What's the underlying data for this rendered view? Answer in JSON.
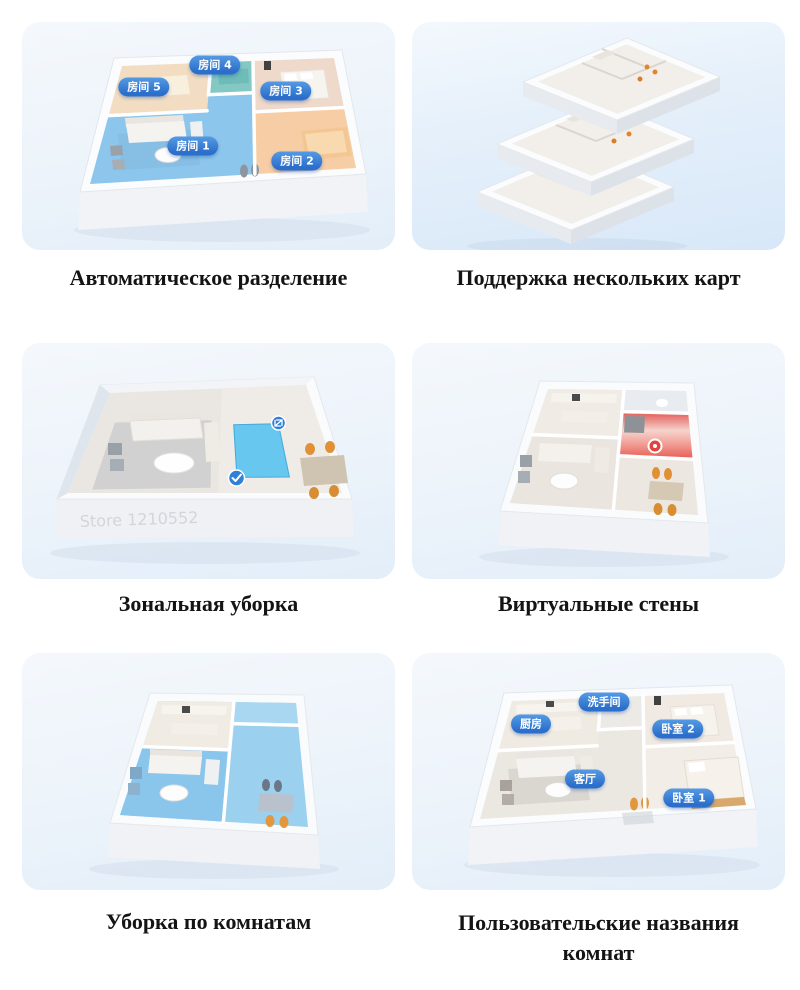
{
  "colors": {
    "badge_blue": "#2e6fce",
    "zone_blue": "#56c5ef",
    "no_go_red": "#e5534e",
    "card_background": "#eaf2fb",
    "caption_text": "#141414"
  },
  "icons": {
    "zone_confirm": "check-icon",
    "zone_resize": "resize-arrows-icon",
    "virtual_wall_marker": "robot-marker-icon"
  },
  "features": [
    {
      "id": "auto-partition",
      "caption": "Автоматическое разделение",
      "rooms": [
        {
          "label": "房间 4"
        },
        {
          "label": "房间 5"
        },
        {
          "label": "房间 3"
        },
        {
          "label": "房间 1"
        },
        {
          "label": "房间 2"
        }
      ]
    },
    {
      "id": "multi-map",
      "caption": "Поддержка нескольких карт"
    },
    {
      "id": "zone-cleaning",
      "caption": "Зональная уборка",
      "watermark": "Store 1210552"
    },
    {
      "id": "virtual-walls",
      "caption": "Виртуальные стены"
    },
    {
      "id": "room-cleaning",
      "caption": "Уборка по комнатам"
    },
    {
      "id": "custom-names",
      "caption": "Пользовательские названия комнат",
      "rooms": [
        {
          "label": "洗手间"
        },
        {
          "label": "厨房"
        },
        {
          "label": "卧室 2"
        },
        {
          "label": "客厅"
        },
        {
          "label": "卧室 1"
        }
      ]
    }
  ]
}
